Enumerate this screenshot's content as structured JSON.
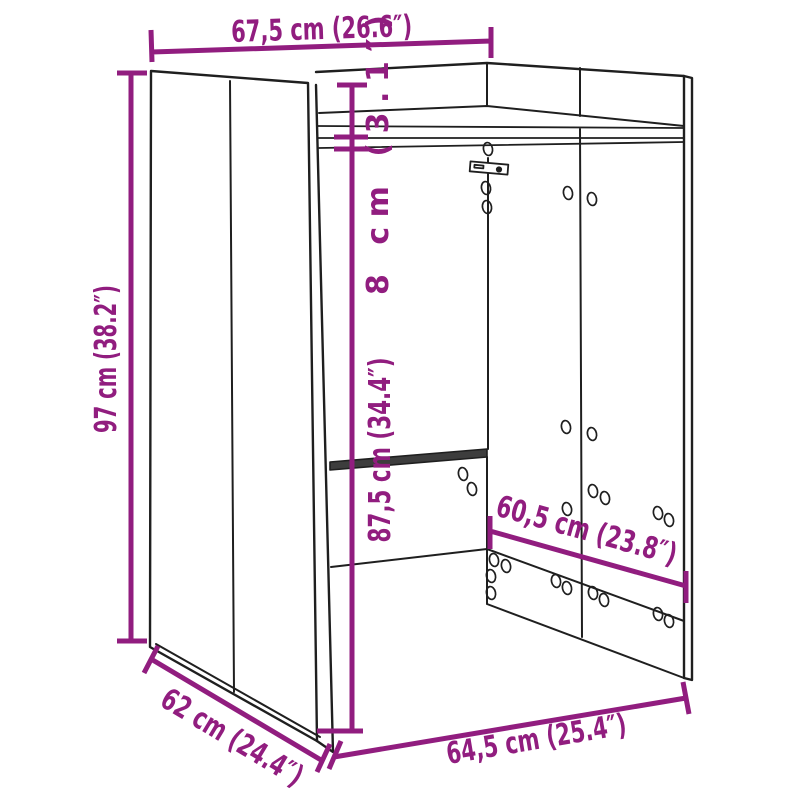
{
  "page": {
    "type": "product-dimension-diagram",
    "subject": "open cabinet / washing machine surround line drawing, perspective view",
    "background": "#ffffff"
  },
  "colors": {
    "accent": "#911d7f",
    "line": "#1f1f1f",
    "panel_fill": "#ffffff",
    "mid_rail_fill": "#3d3d3d"
  },
  "dimensions": {
    "top_width": {
      "label": "67,5 cm (26.6″)",
      "cm": 67.5,
      "in": 26.6
    },
    "side_height": {
      "label": "97 cm (38.2″)",
      "cm": 97,
      "in": 38.2
    },
    "top_clearance": {
      "label": "8 cm (3.1″)",
      "cm": 8,
      "in": 3.1
    },
    "inner_height": {
      "label": "87,5 cm (34.4″)",
      "cm": 87.5,
      "in": 34.4
    },
    "back_rail_width": {
      "label": "60,5 cm (23.8″)",
      "cm": 60.5,
      "in": 23.8
    },
    "depth": {
      "label": "62 cm (24.4″)",
      "cm": 62,
      "in": 24.4
    },
    "bottom_front_width": {
      "label": "64,5 cm (25.4″)",
      "cm": 64.5,
      "in": 25.4
    }
  }
}
